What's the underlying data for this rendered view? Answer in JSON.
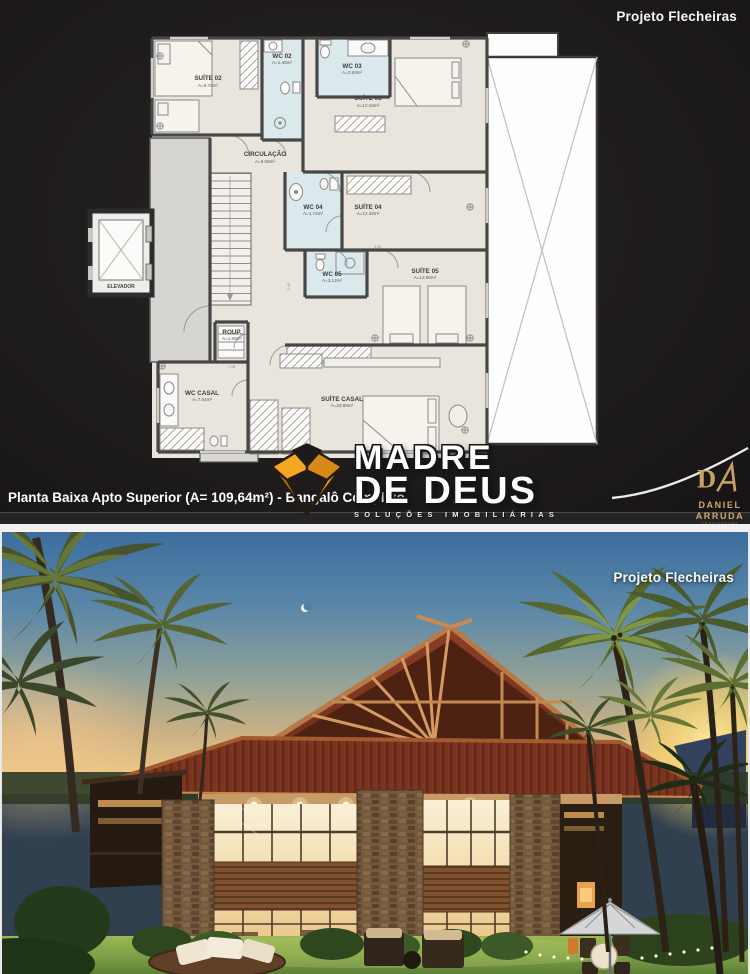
{
  "top_panel": {
    "project_label": "Projeto Flecheiras",
    "caption": "Planta Baixa Apto Superior (A= 109,64m²) - Bangalô Completo"
  },
  "photo_panel": {
    "project_label": "Projeto Flecheiras"
  },
  "watermark": {
    "line1": "MADRE",
    "line2": "DE DEUS",
    "tagline": "SOLUÇÕES IMOBILIÁRIAS",
    "logo_color": "#ef9a1d"
  },
  "architect": {
    "line1": "DANIEL",
    "line2": "ARRUDA",
    "line3": "ARQUITETURA",
    "color": "#c9a063"
  },
  "plan": {
    "rooms": [
      {
        "label": "SUÍTE 02",
        "area": "A=8.70m²"
      },
      {
        "label": "WC 02",
        "area": "A=1.48m²"
      },
      {
        "label": "WC 03",
        "area": "A=2.93m²"
      },
      {
        "label": "SUÍTE 03",
        "area": "A=12.04m²"
      },
      {
        "label": "CIRCULAÇÃO",
        "area": "A=9.06m²"
      },
      {
        "label": "WC 04",
        "area": "A=1.74m²"
      },
      {
        "label": "SUÍTE 04",
        "area": "A=12.32m²"
      },
      {
        "label": "WC 05",
        "area": "A=3.12m²"
      },
      {
        "label": "SUÍTE 05",
        "area": "A=13.90m²"
      },
      {
        "label": "ROUP.",
        "area": "A=1.80m²"
      },
      {
        "label": "WC CASAL",
        "area": "A=7.54m²"
      },
      {
        "label": "SUÍTE CASAL",
        "area": "A=23.80m²"
      },
      {
        "label": "ELEVADOR",
        "area": ""
      }
    ],
    "dimensions": [
      "3.40",
      "2.40",
      "1.08"
    ]
  }
}
